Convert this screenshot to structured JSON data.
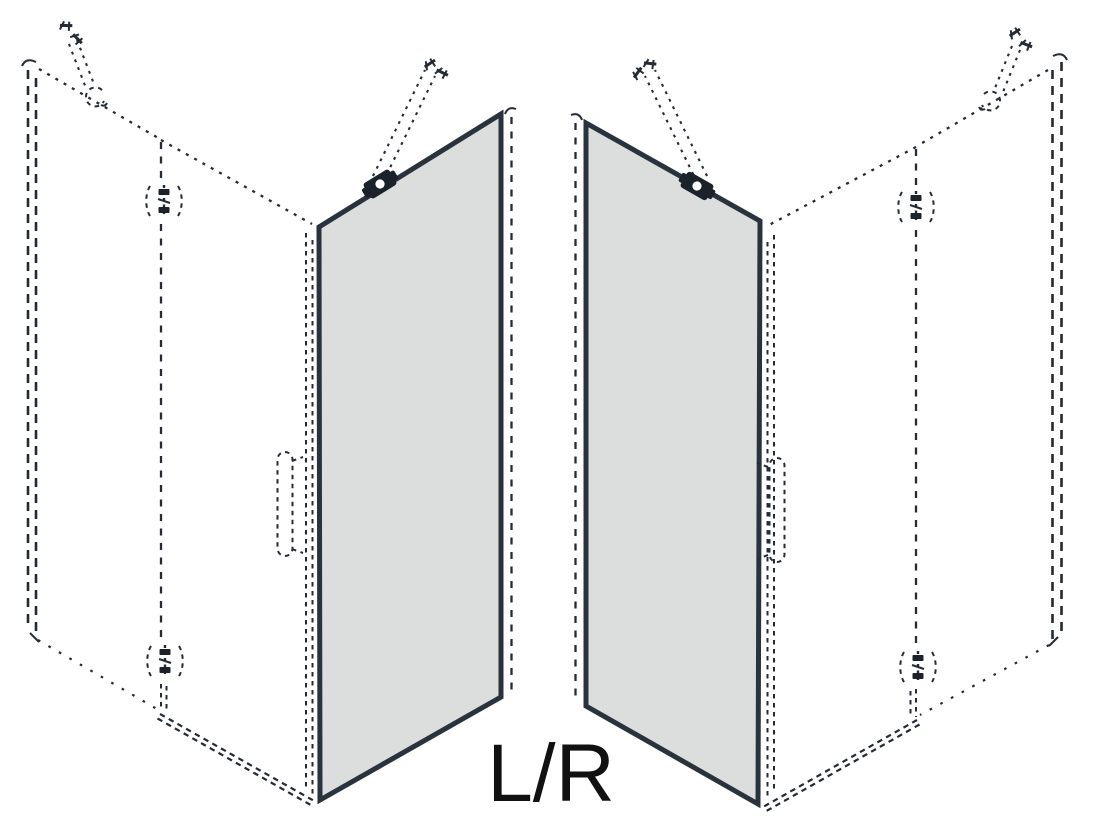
{
  "diagram": {
    "title_label": "L/R",
    "colors": {
      "line": "#242b33",
      "glass_fill": "#dcdddd",
      "glass_edge": "#2a323d",
      "hardware": "#1c222a",
      "text": "#111111",
      "background": "#ffffff"
    },
    "views": [
      {
        "name": "left-door-variant",
        "components": [
          "side-panel-dashed",
          "wall-bracket",
          "mount-screws",
          "hinge-profile-line",
          "upper-hinge",
          "lower-hinge",
          "glass-door-panel",
          "support-bar",
          "glass-clamp",
          "door-handle-dashed",
          "floor-rail"
        ]
      },
      {
        "name": "right-door-variant",
        "components": [
          "side-panel-dashed",
          "wall-bracket",
          "mount-screws",
          "hinge-profile-line",
          "upper-hinge",
          "lower-hinge",
          "glass-door-panel",
          "support-bar",
          "glass-clamp",
          "door-handle-dashed",
          "floor-rail"
        ]
      }
    ]
  }
}
